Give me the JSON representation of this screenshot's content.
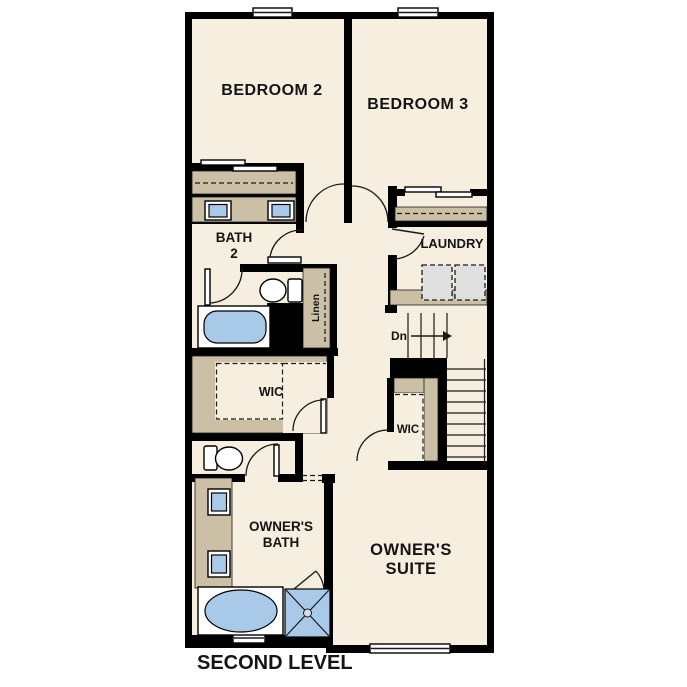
{
  "plan": {
    "level_label": "SECOND LEVEL",
    "rooms": [
      {
        "id": "bedroom2",
        "label": "BEDROOM 2"
      },
      {
        "id": "bedroom3",
        "label": "BEDROOM 3"
      },
      {
        "id": "bath2",
        "label_line1": "BATH",
        "label_line2": "2"
      },
      {
        "id": "laundry",
        "label": "LAUNDRY"
      },
      {
        "id": "linen_closet",
        "label": "Linen"
      },
      {
        "id": "wic_main",
        "label": "WIC"
      },
      {
        "id": "wic_secondary",
        "label": "WIC"
      },
      {
        "id": "owners_bath",
        "label_line1": "OWNER'S",
        "label_line2": "BATH"
      },
      {
        "id": "owners_suite",
        "label_line1": "OWNER'S",
        "label_line2": "SUITE"
      }
    ],
    "stairs": {
      "direction_label": "Dn"
    },
    "fixtures": [
      "window",
      "bypass-closet-doors",
      "double-sink-vanity",
      "toilet",
      "bathtub",
      "oval-tub",
      "shower",
      "washer",
      "dryer",
      "linen-shelves",
      "stairs"
    ],
    "colors": {
      "wall": "#000000",
      "floor": "#f6eede",
      "cabinet": "#cbc0a6",
      "fixture_blue": "#a9c9e9",
      "appliance_gray": "#e0e0e0",
      "paper": "#ffffff",
      "line": "#1a1a1a"
    }
  }
}
